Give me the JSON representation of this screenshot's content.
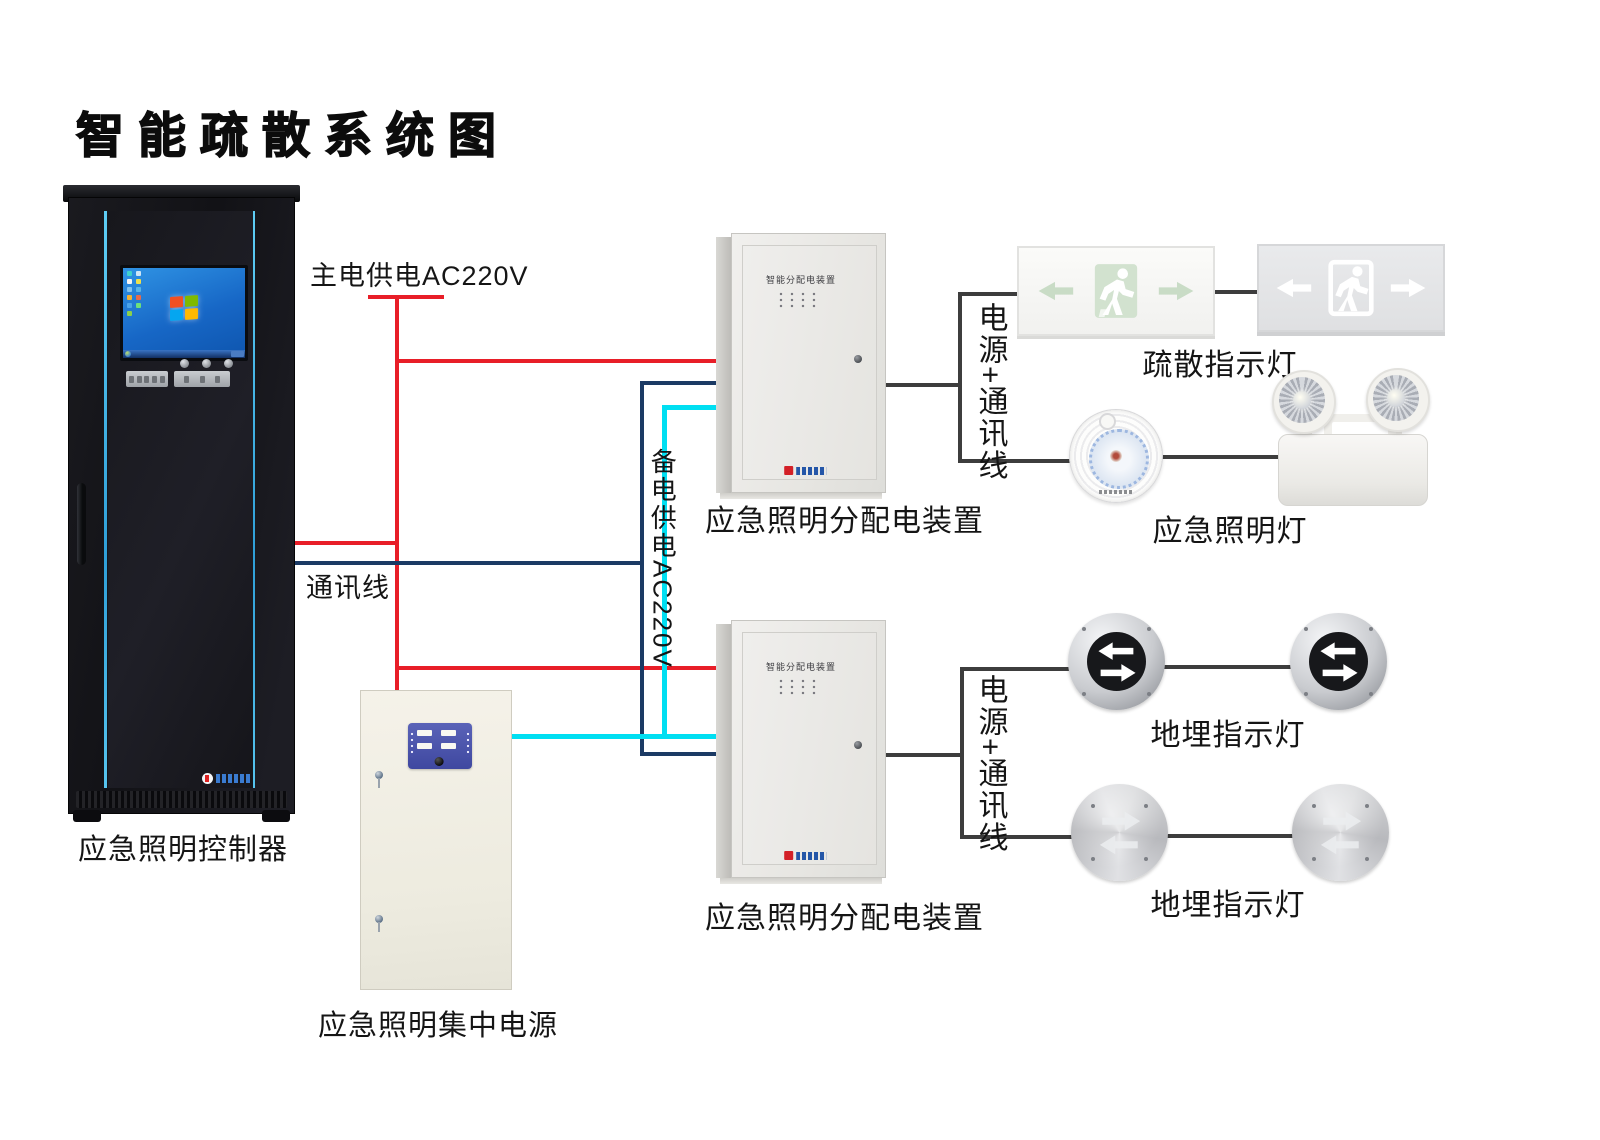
{
  "title": "智能疏散系统图",
  "colors": {
    "main_power_wire": "#e81e28",
    "comm_wire": "#1b3a64",
    "backup_power_wire": "#00dff2",
    "device_wire": "#3d3d3d",
    "rack_accent": "#3fb6e8"
  },
  "wires": {
    "main_power": "主电供电AC220V",
    "comm": "通讯线",
    "backup_power": "备电供电AC220V",
    "power_comm": "电源+通讯线"
  },
  "controller": {
    "label": "应急照明控制器"
  },
  "power_supply": {
    "label": "应急照明集中电源"
  },
  "distribution": {
    "panel_title": "智能分配电装置",
    "label": "应急照明分配电装置"
  },
  "devices": {
    "exit_sign_label": "疏散指示灯",
    "emergency_light_label": "应急照明灯",
    "ground_light_label": "地埋指示灯"
  }
}
